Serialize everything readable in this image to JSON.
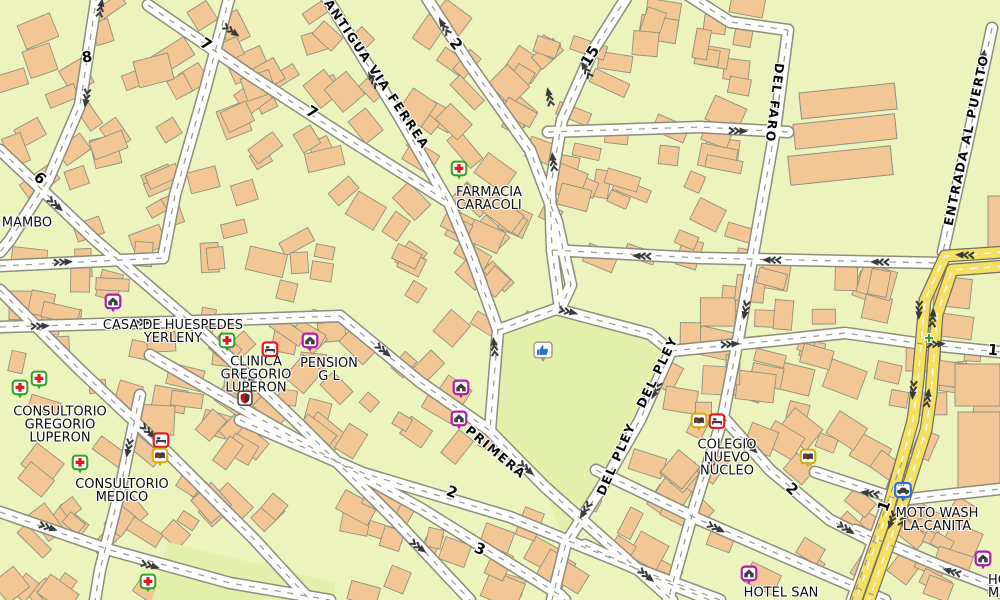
{
  "map": {
    "colors": {
      "background": "#ecf3bd",
      "park": "#e3f0ab",
      "building": "#f3c795",
      "building_outline": "#90907f",
      "road_fill": "#fefefe",
      "road_casing": "#8e8e7c",
      "road_centerline": "#9a9a8a",
      "highway_fill": "#f3e065",
      "highway_casing": "#70705c",
      "arrow": "#3a3a3a",
      "label": "#0d0d0d",
      "lodging_icon": "#b21ab2",
      "first_aid_icon": "#2da32d",
      "school_icon": "#d9a80b",
      "red_box_icon": "#df1b1b",
      "car_wash_icon": "#2f6fd8"
    },
    "streets": {
      "antigua": "ANTIGUA VIA FERREA",
      "del_faro": "DEL FARO",
      "entrada": "ENTRADA AL PUERTO",
      "primera": "PRIMERA",
      "del_pley_1": "DEL PLEY",
      "del_pley_2": "DEL PLEY",
      "mambo": "MAMBO",
      "n2_top": "2",
      "n15": "15",
      "n7_top": "7",
      "n7_mid": "7",
      "n8": "8",
      "n6": "6",
      "n2_mid": "2",
      "n2_bottom": "2",
      "n3": "3",
      "n1_right": "1",
      "n1_cross": "1"
    },
    "pois": {
      "farmacia": {
        "lines": [
          "FARMACIA",
          "CARACOLI"
        ],
        "icon": "first-aid-icon"
      },
      "casa": {
        "lines": [
          "CASA DE HUESPEDES",
          "YERLENY"
        ],
        "icon": "lodging-icon"
      },
      "clinica": {
        "lines": [
          "CLINICA",
          "GREGORIO",
          "LUPERON"
        ],
        "icon": "red-box-icon"
      },
      "pension": {
        "lines": [
          "PENSION",
          "G L"
        ],
        "icon": "lodging-icon"
      },
      "consultorio_gregorio": {
        "lines": [
          "CONSULTORIO",
          "GREGORIO",
          "LUPERON"
        ],
        "icon": "first-aid-icon"
      },
      "consultorio_medico": {
        "lines": [
          "CONSULTORIO",
          "MEDICO"
        ],
        "icon": "first-aid-icon"
      },
      "colegio": {
        "lines": [
          "COLEGIO",
          "NUEVO",
          "NUCLEO"
        ],
        "icon": "school-icon"
      },
      "moto_wash": {
        "lines": [
          "MOTO WASH",
          "LA-CANITA"
        ],
        "icon": "car-wash-icon"
      },
      "hotel_san": {
        "lines": [
          "HOTEL SAN"
        ],
        "icon": "lodging-icon"
      },
      "hotel_mi": {
        "lines": [
          "HO",
          "MI"
        ],
        "icon": "lodging-icon"
      }
    },
    "icons": [
      "lodging-icon",
      "first-aid-icon",
      "school-icon",
      "red-box-icon",
      "shield-icon",
      "car-wash-icon",
      "thumbs-up-icon",
      "green-plus-icon"
    ]
  }
}
